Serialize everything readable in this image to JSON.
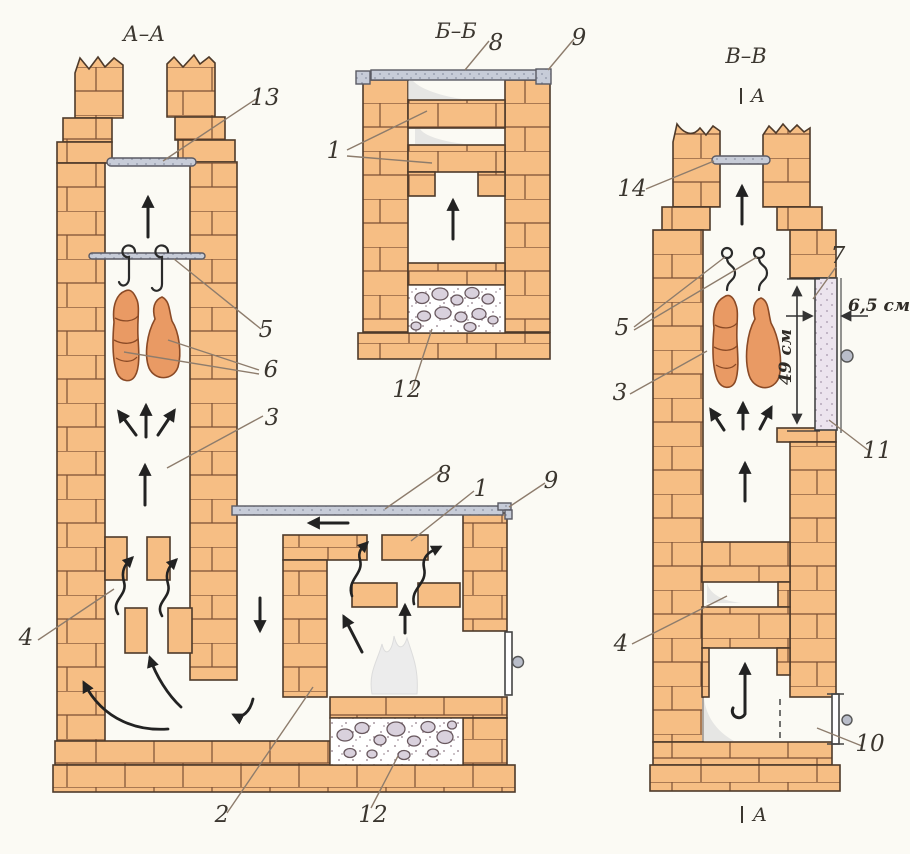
{
  "sections": {
    "aa": {
      "title": "А–А",
      "callouts": {
        "c13": "13",
        "c5": "5",
        "c6": "6",
        "c3": "3",
        "c4": "4",
        "c2": "2",
        "c12": "12",
        "c8": "8",
        "c1": "1",
        "c9": "9"
      }
    },
    "bb": {
      "title": "Б–Б",
      "callouts": {
        "c8": "8",
        "c9": "9",
        "c1": "1",
        "c12": "12"
      }
    },
    "vv": {
      "title": "В–В",
      "marker_top": "А",
      "marker_bottom": "А",
      "callouts": {
        "c14": "14",
        "c5": "5",
        "c3": "3",
        "c7": "7",
        "c11": "11",
        "c4": "4",
        "c10": "10"
      },
      "dimensions": {
        "door_thickness": "6,5 см",
        "opening_height": "49 см"
      }
    }
  },
  "colors": {
    "paper": "#fbfaf4",
    "brick": "#f6be84",
    "brick_joint": "#7c5034",
    "outline": "#4e3a2a",
    "metal": "#c7ccd8",
    "meat": "#e99a64",
    "stone": "#d9d1dd",
    "smoke": "#d8d8d8",
    "arrow": "#222222",
    "leader": "#8d7c6c"
  }
}
